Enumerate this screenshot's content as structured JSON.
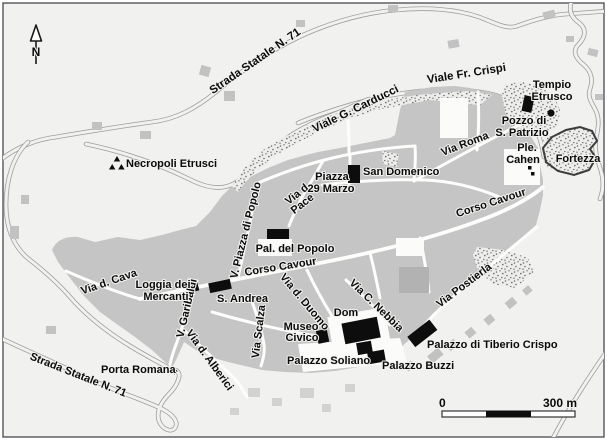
{
  "map": {
    "compass": {
      "north_label": "N"
    },
    "scale_bar": {
      "start_label": "0",
      "end_label": "300 m"
    },
    "streets": {
      "strada_statale": "Strada Statale N. 71",
      "viale_fr_crispi": "Viale Fr. Crispi",
      "viale_g_carducci": "Viale G. Carducci",
      "via_roma": "Via Roma",
      "corso_cavour": "Corso Cavour",
      "via_d_pace_line1": "Via d.",
      "via_d_pace_line2": "Pace",
      "v_piazza_di_popolo": "V. Piazza di Popolo",
      "via_d_cava": "Via d. Cava",
      "v_garibaldi": "V. Garibaldi",
      "via_scalza": "Via Scalza",
      "via_d_duomo": "Via d. Duomo",
      "via_c_nebbia": "Via C. Nebbia",
      "via_postierla": "Via Postierla",
      "via_d_alberici": "Via d. Alberici"
    },
    "places": {
      "tempio_etrusco_line1": "Tempio",
      "tempio_etrusco_line2": "Etrusco",
      "pozzo_line1": "Pozzo di",
      "pozzo_line2": "S. Patrizio",
      "ple_cahen_line1": "Ple.",
      "ple_cahen_line2": "Cahen",
      "fortezza": "Fortezza",
      "necropoli_etrusci": "Necropoli Etrusci",
      "piazza_29_marzo_line1": "Piazza",
      "piazza_29_marzo_line2": "29 Marzo",
      "san_domenico": "San Domenico",
      "pal_del_popolo": "Pal. del Popolo",
      "loggia_line1": "Loggia dei",
      "loggia_line2": "Mercanti",
      "s_andrea": "S. Andrea",
      "museo_civico_line1": "Museo",
      "museo_civico_line2": "Civico",
      "dom": "Dom",
      "palazzo_soliano": "Palazzo Soliano",
      "palazzo_buzzi": "Palazzo Buzzi",
      "palazzo_di_tiberio_crispo": "Palazzo di Tiberio Crispo",
      "porta_romana": "Porta Romana"
    },
    "colors": {
      "background": "#f1f1ef",
      "city_block": "#c5c5c5",
      "building_dark": "#b2b2b2",
      "road_casing": "#9e9e9e",
      "landmark_black": "#0d0d0d",
      "label_text": "#0b0b0b",
      "frame": "#55565a"
    }
  }
}
